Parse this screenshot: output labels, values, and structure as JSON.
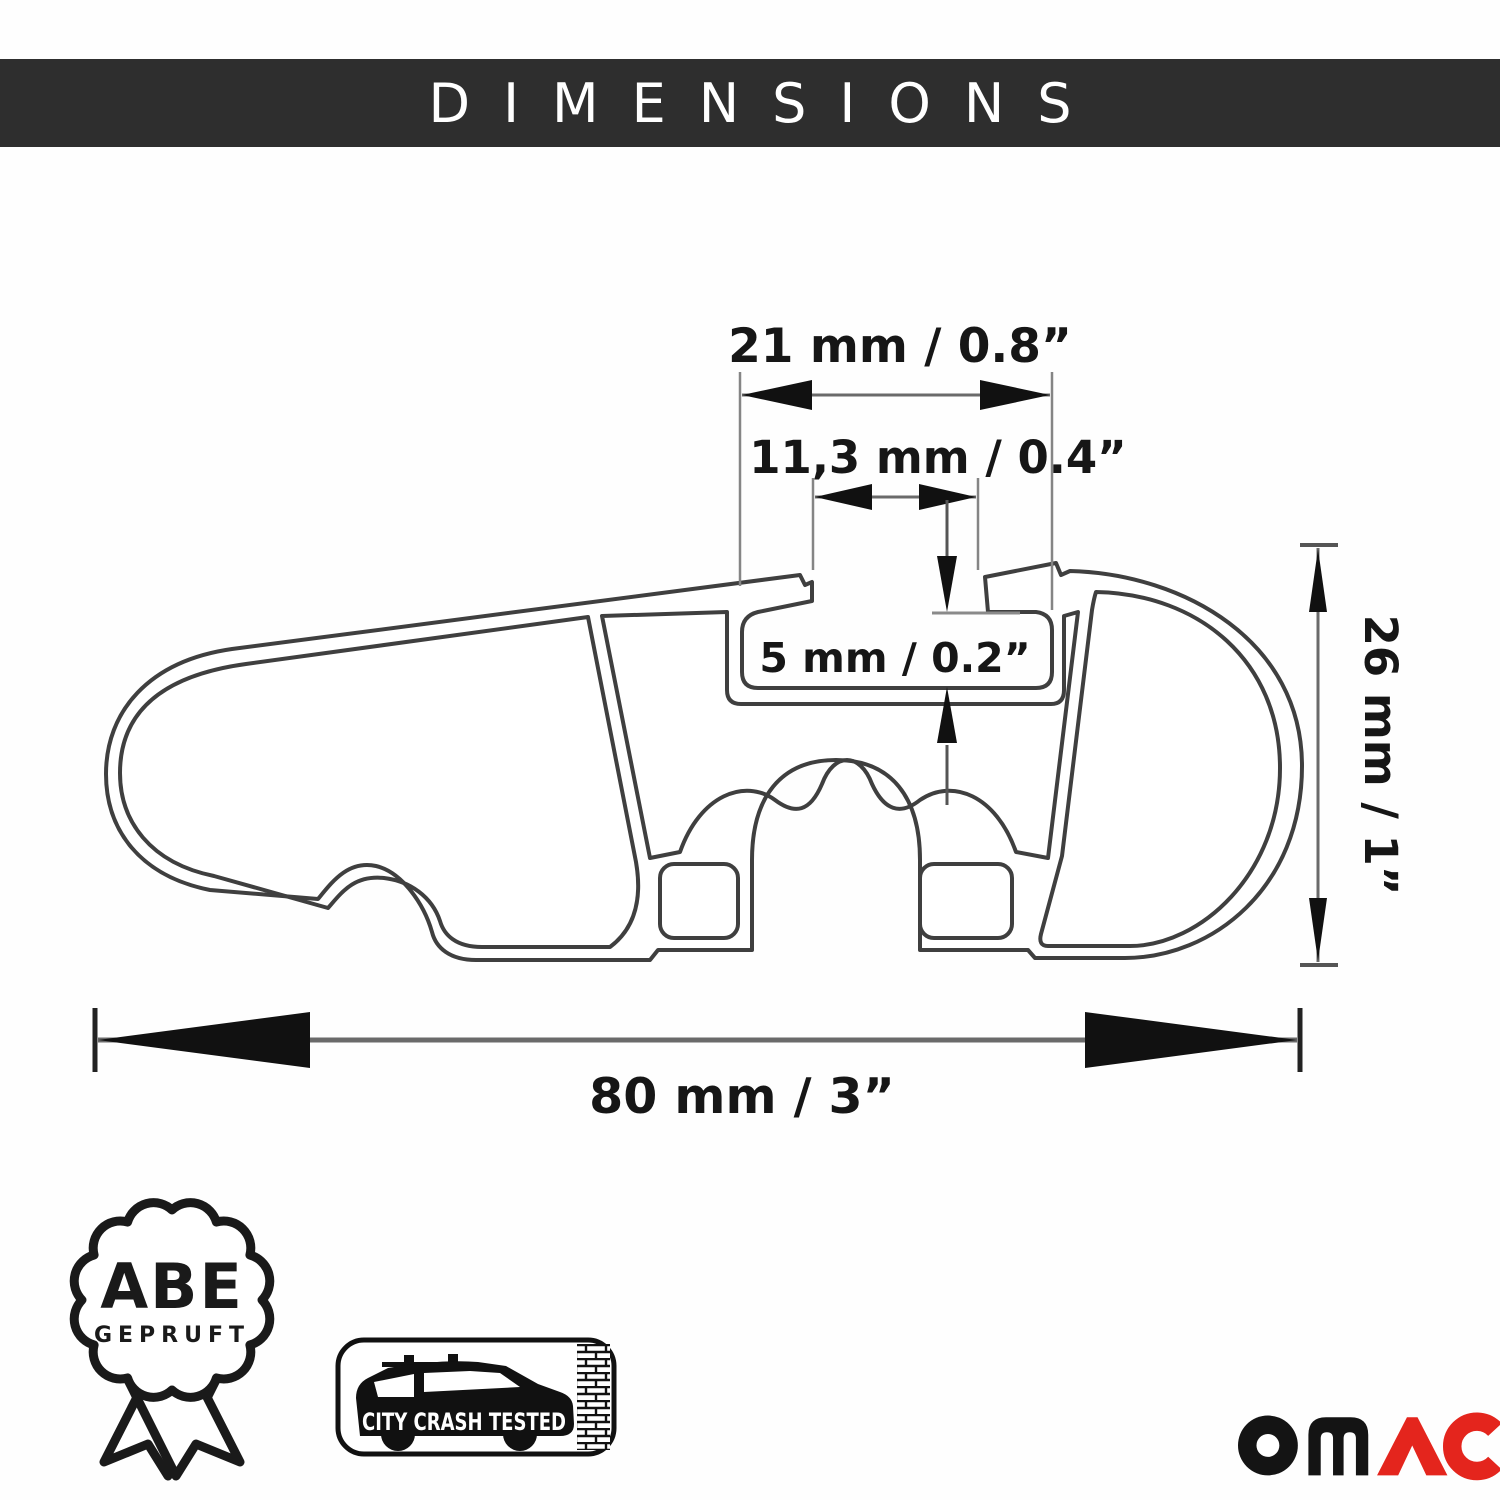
{
  "header": {
    "title": "DIMENSIONS",
    "bg_color": "#2e2e2e",
    "text_color": "#ffffff"
  },
  "diagram": {
    "type": "technical-cross-section",
    "subject": "roof rack crossbar aluminum profile",
    "line_color": "#3f3f3f",
    "extension_line_color": "#858585",
    "arrow_color": "#111111",
    "dimensions": {
      "slot_outer_width": "21 mm / 0.8”",
      "slot_opening_width": "11,3 mm / 0.4”",
      "slot_depth": "5 mm / 0.2”",
      "profile_height": "26 mm / 1”",
      "profile_width": "80 mm / 3”"
    }
  },
  "badges": {
    "abe": {
      "line1": "ABE",
      "line2": "GEPRUFT"
    },
    "crash": {
      "label": "CITY CRASH TESTED"
    }
  },
  "logo": {
    "brand": "OMAC",
    "black_part": "OM",
    "red_part": "AC",
    "black_color": "#141414",
    "red_color": "#e4251d"
  }
}
